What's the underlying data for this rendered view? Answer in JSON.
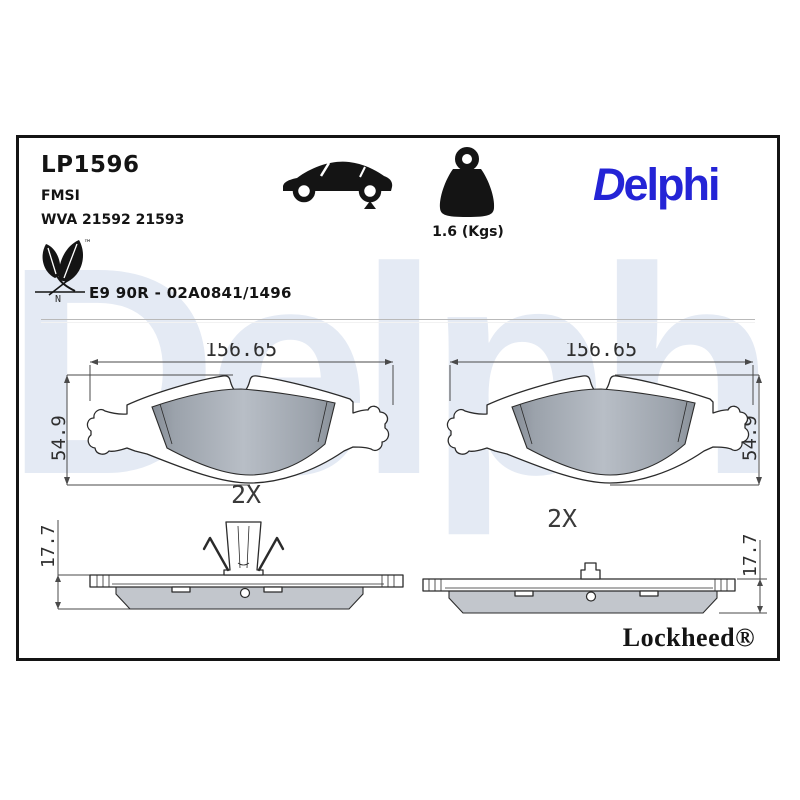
{
  "header": {
    "part_number": "LP1596",
    "fmsi_label": "FMSI",
    "wva_numbers": "WVA 21592 21593",
    "weight": "1.6 (Kgs)",
    "brand_logo": "Delphi"
  },
  "approval": {
    "eco_tm": "™",
    "eco_n": "N",
    "text": "E9 90R - 02A0841/1496"
  },
  "drawings": {
    "front_width": "156.65",
    "front_height": "54.9",
    "front_qty": "2X",
    "side_thickness": "17.7"
  },
  "footer": {
    "lockheed": "Lockheed®"
  },
  "watermark": "Delphi",
  "colors": {
    "brand_blue": "#2424D6",
    "watermark_blue": "#E4EAF4",
    "friction_gray": "#ADB3BB",
    "drawing_line": "#2B2B2B"
  },
  "icons": {
    "car": "car-rear-axle-icon",
    "weight": "weight-icon",
    "leaf": "eco-leaf-icon"
  }
}
